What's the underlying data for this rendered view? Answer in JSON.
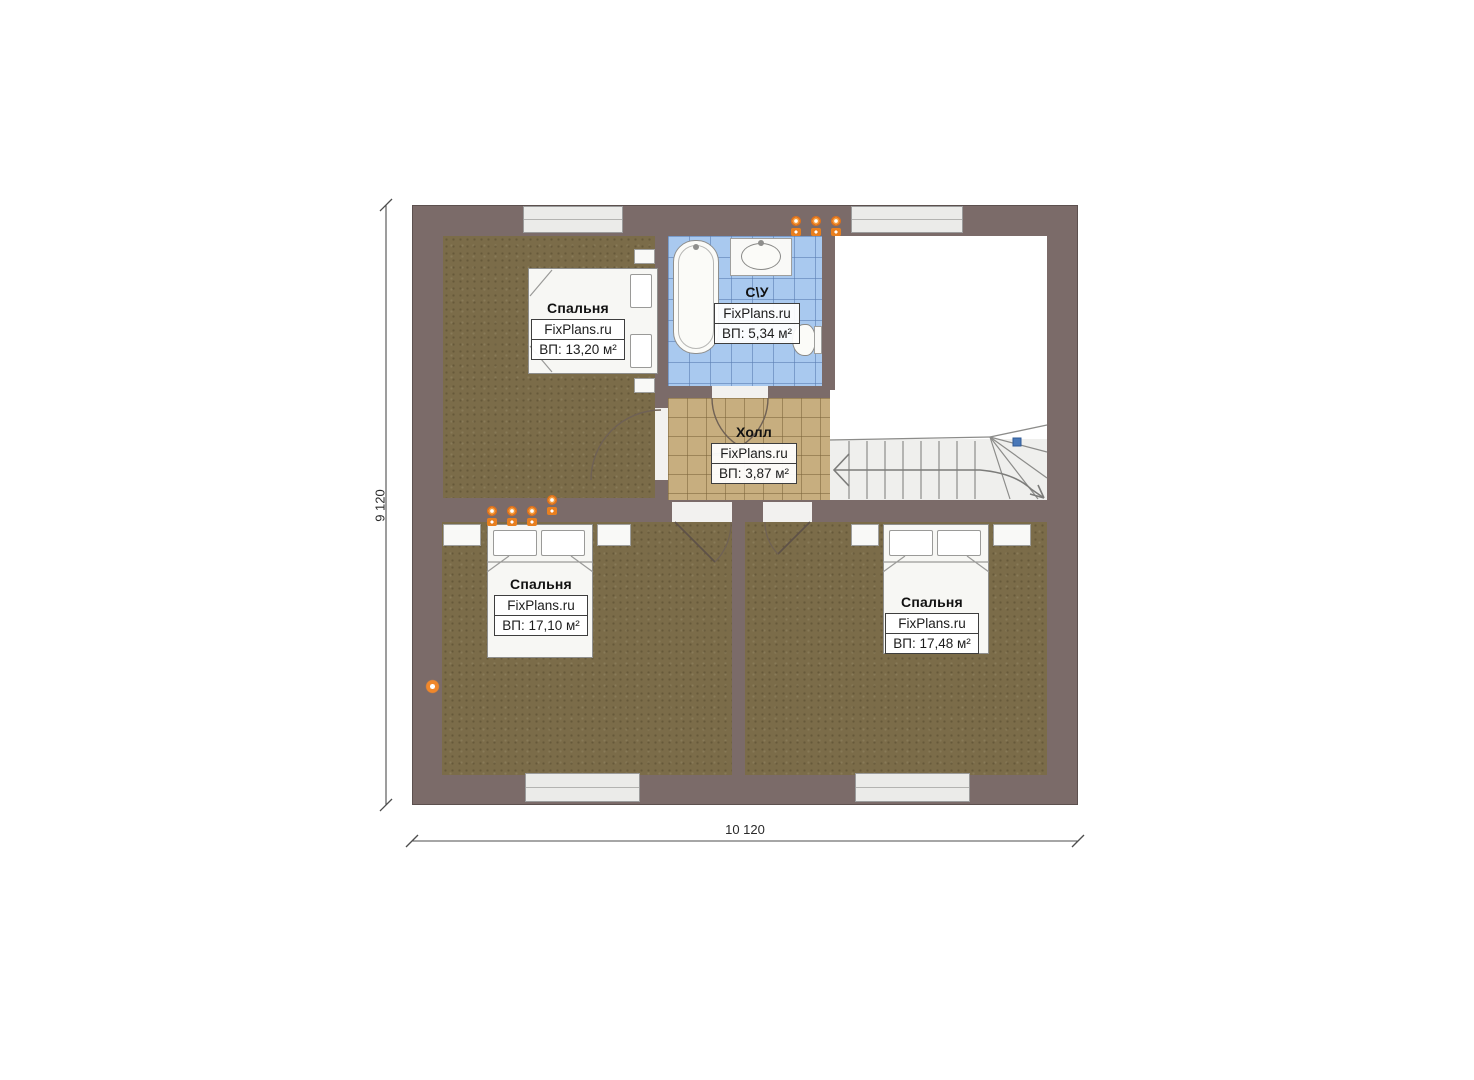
{
  "plan": {
    "type": "floor-plan",
    "branding": "FixPlans.ru",
    "rooms": [
      {
        "id": "bedroom-top-left",
        "name": "Спальня",
        "brand": "FixPlans.ru",
        "area": "ВП: 13,20 м²"
      },
      {
        "id": "bathroom",
        "name": "С\\У",
        "brand": "FixPlans.ru",
        "area": "ВП: 5,34 м²"
      },
      {
        "id": "hall",
        "name": "Холл",
        "brand": "FixPlans.ru",
        "area": "ВП: 3,87 м²"
      },
      {
        "id": "bedroom-bottom-left",
        "name": "Спальня",
        "brand": "FixPlans.ru",
        "area": "ВП: 17,10 м²"
      },
      {
        "id": "bedroom-bottom-right",
        "name": "Спальня",
        "brand": "FixPlans.ru",
        "area": "ВП: 17,48 м²"
      }
    ],
    "dimensions": {
      "vertical": "9 120",
      "horizontal": "10 120"
    },
    "colors": {
      "wall": "#7b6b69",
      "bedroom_floor": "#7b6c49",
      "hall_tile": "#c7ae7f",
      "bath_tile": "#a9c9ef",
      "lamp_orange": "#e87f1f",
      "stair_marker_blue": "#4a78b8"
    }
  }
}
